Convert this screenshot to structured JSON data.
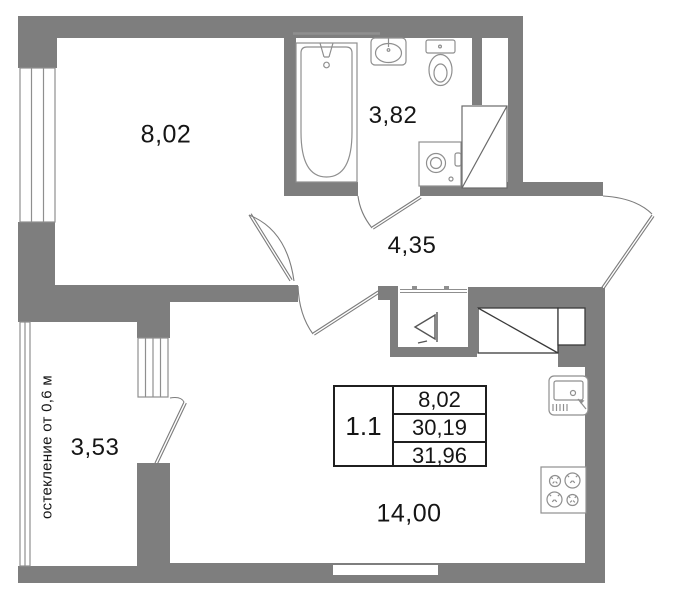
{
  "rooms": {
    "bedroom": {
      "area": "8,02"
    },
    "bathroom": {
      "area": "3,82"
    },
    "hallway": {
      "area": "4,35"
    },
    "balcony": {
      "area": "3,53",
      "note": "остекление от 0,6 м"
    },
    "living": {
      "area": "14,00"
    }
  },
  "info_table": {
    "unit": "1.1",
    "values": [
      "8,02",
      "30,19",
      "31,96"
    ]
  },
  "symbols": [
    "bathtub",
    "wash-basin",
    "toilet",
    "washing-machine",
    "vent-shaft",
    "towel-rail",
    "wardrobe",
    "panel-niche",
    "kitchen-sink",
    "stove",
    "entrance-door",
    "room-door",
    "hall-door",
    "bathroom-door",
    "balcony-door",
    "window",
    "glazing"
  ],
  "colors": {
    "wall": "#7e7e7e",
    "fixture_line": "#8f8f8f",
    "dark_line": "#4a4a4a",
    "text": "#151515",
    "background": "#ffffff"
  }
}
